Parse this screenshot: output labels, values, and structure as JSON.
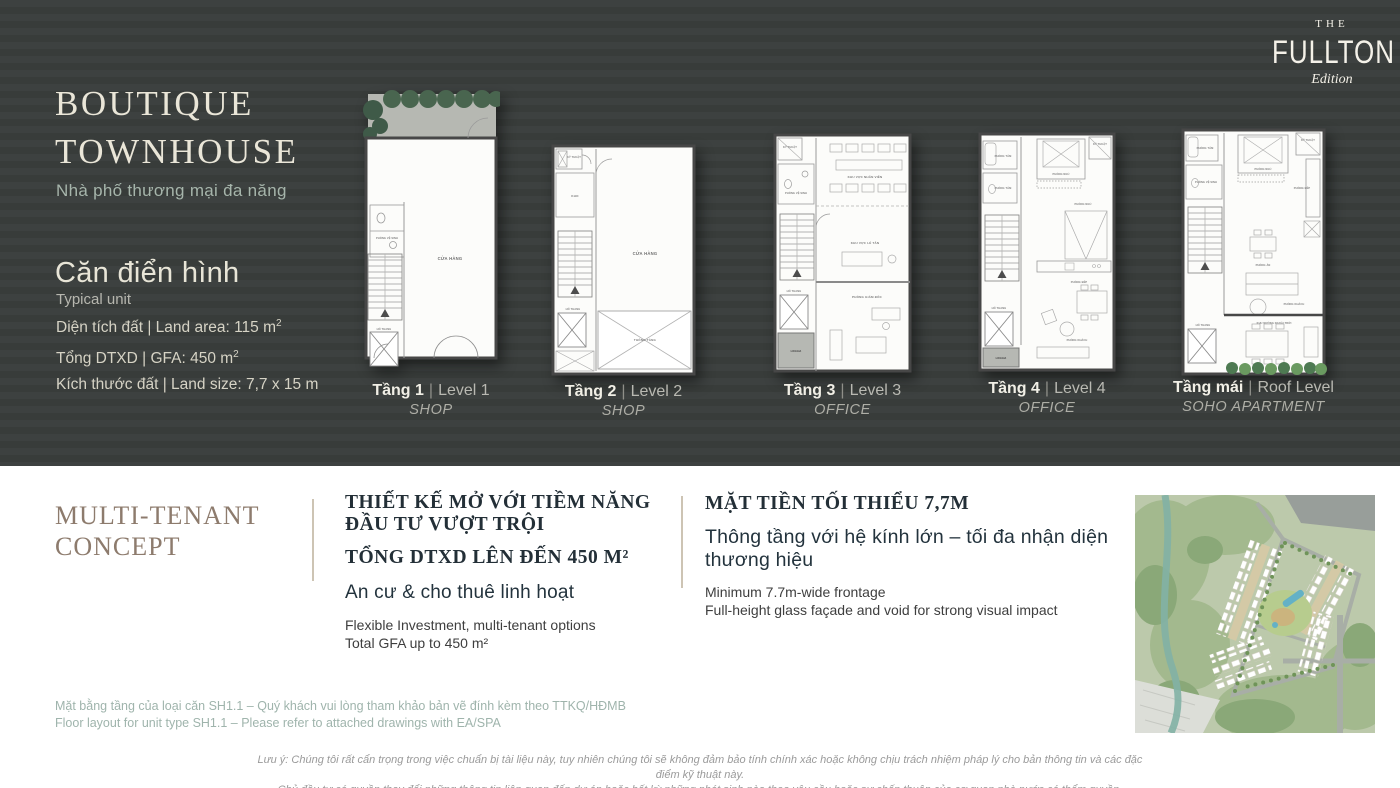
{
  "brand": {
    "the": "THE",
    "name": "FULLTON",
    "edition": "Edition"
  },
  "colors": {
    "dark_bg": "#3a3e3d",
    "cream": "#eae6d8",
    "teal_text": "#a6b5ab",
    "taupe_heading": "#8d7b6d",
    "dark_heading": "#232f37",
    "note_teal": "#9fb4ac"
  },
  "hero": {
    "title_line1": "BOUTIQUE",
    "title_line2": "TOWNHOUSE",
    "subtitle": "Nhà phố thương mại đa năng",
    "unit_heading": "Căn điển hình",
    "unit_subheading": "Typical unit",
    "spec1_label": "Diện tích đất | Land area:  115 m",
    "spec1_sup": "2",
    "spec2_label": "Tổng DTXD | GFA: 450 m",
    "spec2_sup": "2",
    "spec3_label": "Kích thước đất | Land size: 7,7 x 15 m"
  },
  "plans_sep": "|",
  "plans": [
    {
      "floor": "Tầng 1",
      "level": "Level 1",
      "type": "SHOP",
      "rooms": [
        "CỬA HÀNG",
        "PHÒNG VỆ SINH",
        "HỐ THANG"
      ]
    },
    {
      "floor": "Tầng 2",
      "level": "Level 2",
      "type": "SHOP",
      "rooms": [
        "KỸ THUẬT",
        "KHO",
        "CỬA HÀNG",
        "THÔNG TẦNG",
        "HỐ THANG"
      ]
    },
    {
      "floor": "Tầng 3",
      "level": "Level 3",
      "type": "OFFICE",
      "rooms": [
        "KỸ THUẬT",
        "PHÒNG VỆ SINH",
        "KHU VỰC NHÂN VIÊN",
        "KHU VỰC LỄ TÂN",
        "PHÒNG GIÁM ĐỐC",
        "HỐ THANG",
        "LOGGIA"
      ]
    },
    {
      "floor": "Tầng 4",
      "level": "Level 4",
      "type": "OFFICE",
      "rooms": [
        "PHÒNG TẮM",
        "PHÒNG TẮM",
        "KỸ THUẬT",
        "PHÒNG NGỦ",
        "PHÒNG NGỦ",
        "PHÒNG BẾP",
        "HỐ THANG",
        "PHÒNG KHÁCH",
        "LOGGIA"
      ]
    },
    {
      "floor": "Tầng mái",
      "level": "Roof Level",
      "type": "SOHO APARTMENT",
      "rooms": [
        "PHÒNG TẮM",
        "PHÒNG VỆ SINH",
        "KỸ THUẬT",
        "PHÒNG NGỦ",
        "PHÒNG BẾP",
        "PHÒNG ĂN",
        "PHÒNG KHÁCH",
        "HỐ THANG",
        "KHU NƯỚNG NGOÀI TRỜI"
      ]
    }
  ],
  "concept": {
    "heading_line1": "MULTI-TENANT",
    "heading_line2": "CONCEPT",
    "block1": {
      "title_line1": "THIẾT KẾ MỞ VỚI TIỀM NĂNG",
      "title_line2": "ĐẦU TƯ VƯỢT TRỘI",
      "title2": "TỔNG DTXD LÊN ĐẾN 450 M²",
      "vn": "An cư &  cho thuê linh hoạt",
      "en_line1": "Flexible Investment, multi-tenant options",
      "en_line2": "Total GFA up to 450 m²"
    },
    "block2": {
      "title": "MẶT TIỀN TỐI THIỂU 7,7M",
      "vn": "Thông tầng với hệ kính lớn – tối đa nhận diện thương hiệu",
      "en_line1": "Minimum 7.7m-wide frontage",
      "en_line2": "Full-height glass façade and void for strong visual impact"
    }
  },
  "notes": {
    "vn": "Mặt bằng tầng của loại căn SH1.1 – Quý khách vui lòng tham khảo bản vẽ đính kèm theo TTKQ/HĐMB",
    "en": "Floor layout for unit type SH1.1 – Please refer to  attached drawings with EA/SPA"
  },
  "disclaimer": {
    "line1": "Lưu ý: Chúng tôi rất cẩn trọng trong việc chuẩn bị tài liệu này, tuy nhiên chúng tôi sẽ không đảm bảo tính chính xác hoặc không chịu trách nhiệm pháp lý cho bản thông tin và các đặc điểm kỹ thuật này.",
    "line2": "Chủ đầu tư có quyền thay đổi những thông tin liên quan đến dự án hoặc bất kỳ những phát sinh nào theo yêu cầu hoặc sự chấp thuận của cơ quan nhà nước có thẩm quyền."
  }
}
